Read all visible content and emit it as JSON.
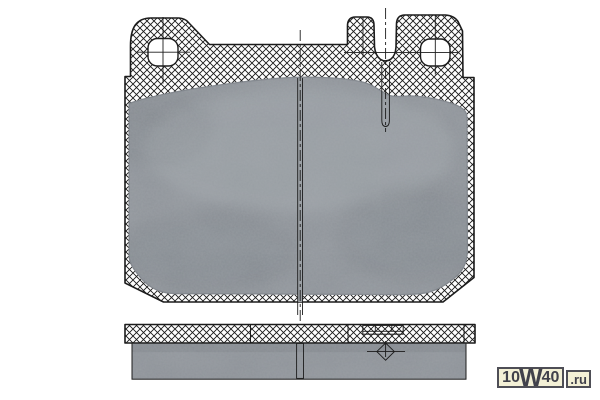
{
  "watermark": {
    "prefix": "10",
    "letter": "W",
    "suffix": "40",
    "domain": ".ru"
  },
  "colors": {
    "background": "#ffffff",
    "line": "#1c1c1c",
    "hatch": "#1a1a1a",
    "friction": "#8e9399",
    "friction_light": "#a4aaaf",
    "friction_dark": "#6e747a",
    "groove": "#9ba0a5",
    "wm_bg": "#f3f0d6",
    "wm_border": "#4e4e56",
    "wm_text": "#41414b"
  }
}
